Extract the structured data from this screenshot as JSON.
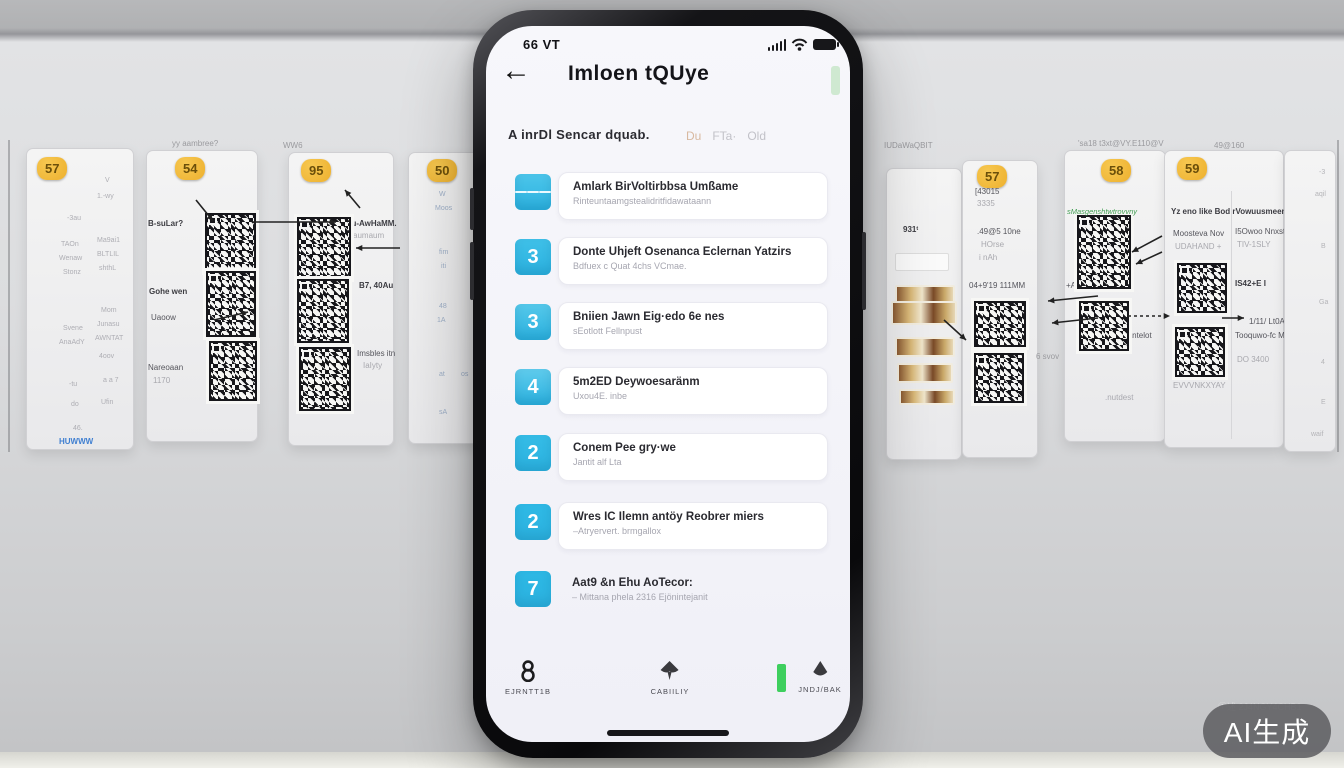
{
  "watermark": {
    "text": "AI生成",
    "faint": "①述 2J4NGY4CHB1"
  },
  "phone": {
    "status_bar": {
      "time": "66 VT",
      "icons": [
        "signal-icon",
        "wifi-icon",
        "battery-icon"
      ]
    },
    "header": {
      "back_icon": "←",
      "title": "Imloen tQUye",
      "pill_color": "#cfe9d1"
    },
    "filter": {
      "left": "A inrDl Sencar dquab.",
      "tags": [
        "Du",
        "FTa·",
        "Old"
      ],
      "tag0_color": "#d8b9a0"
    },
    "list": [
      {
        "badge": {
          "type": "list-icon",
          "value": ""
        },
        "color": "#4cc5ea",
        "title": "Amlark BirVoltirbbsa Umßame",
        "subtitle": "Rinteuntaamgstealidritfidawataann",
        "card": true
      },
      {
        "badge": {
          "type": "number",
          "value": "3"
        },
        "color": "#3fc0e8",
        "title": "Donte Uhjeft Osenanca Eclernan Yatzirs",
        "subtitle": "Bdfuex c Quat 4chs VCmae.",
        "card": true
      },
      {
        "badge": {
          "type": "number",
          "value": "3"
        },
        "color": "#55c8ea",
        "title": "Bniien Jawn Eig·edo 6e nes",
        "subtitle": "sEotlott Fellnpust",
        "card": true
      },
      {
        "badge": {
          "type": "number",
          "value": "4"
        },
        "color": "#5fcbec",
        "title": "5m2ED Deywoesaränm",
        "subtitle": "Uxou4E. inbe",
        "card": true
      },
      {
        "badge": {
          "type": "number",
          "value": "2"
        },
        "color": "#35bce6",
        "title": "Conem Pee gry·we",
        "subtitle": "Jantit alf Lta",
        "card": true
      },
      {
        "badge": {
          "type": "number",
          "value": "2"
        },
        "color": "#2fb9e5",
        "title": "Wres IC Ilemn antöy Reobrer miers",
        "subtitle": "–Atryervert. brmgallox",
        "card": true
      },
      {
        "badge": {
          "type": "number",
          "value": "7"
        },
        "color": "#2db8e4",
        "title": "Aat9 &n Ehu AoTecor:",
        "subtitle": "– Mittana phela 2316 Ejönintejanit",
        "card": false
      }
    ],
    "row_tops": [
      146,
      211,
      276,
      341,
      407,
      476,
      543
    ],
    "nav": [
      {
        "icon": "person-icon",
        "label": "EJRNTT1B"
      },
      {
        "icon": "spade-icon",
        "label": "CABIILIY"
      },
      {
        "icon": "droplet-icon",
        "label": "JNDJ/BAK",
        "accent": "#3ecf5e"
      }
    ]
  },
  "wall": {
    "badge_color": "#edb02e",
    "labels": [
      {
        "t": "yy aambree?",
        "x": 172,
        "y": 139
      },
      {
        "t": "WW6",
        "x": 283,
        "y": 141
      },
      {
        "t": "IUDaWaQBIT",
        "x": 884,
        "y": 141
      },
      {
        "t": "'sa18 t3xt@VY.E110@V",
        "x": 1078,
        "y": 139
      },
      {
        "t": "49@160",
        "x": 1214,
        "y": 141
      },
      {
        "t": "6 svov",
        "x": 1036,
        "y": 352
      }
    ],
    "panels": [
      {
        "x": 26,
        "y": 148,
        "w": 106,
        "h": 300,
        "badge": {
          "t": "57",
          "x": 10,
          "y": 8
        },
        "rows": [
          {
            "t": "V",
            "x": 78,
            "y": 28
          },
          {
            "t": "1.-wy",
            "x": 70,
            "y": 44
          },
          {
            "t": "-3au",
            "x": 40,
            "y": 66
          },
          {
            "t": "TAOn",
            "x": 34,
            "y": 92
          },
          {
            "t": "Ma9ai1",
            "x": 70,
            "y": 88
          },
          {
            "t": "Wenaw",
            "x": 32,
            "y": 106
          },
          {
            "t": "BLTLIL",
            "x": 70,
            "y": 102
          },
          {
            "t": "Stonz",
            "x": 36,
            "y": 120
          },
          {
            "t": "shthL",
            "x": 72,
            "y": 116
          },
          {
            "t": "Mom",
            "x": 74,
            "y": 158
          },
          {
            "t": "Svene",
            "x": 36,
            "y": 176
          },
          {
            "t": "Junasu",
            "x": 70,
            "y": 172
          },
          {
            "t": "AnaAdY",
            "x": 32,
            "y": 190
          },
          {
            "t": "AWNTAT",
            "x": 68,
            "y": 186
          },
          {
            "t": "4oov",
            "x": 72,
            "y": 204
          },
          {
            "t": "-tu",
            "x": 42,
            "y": 232
          },
          {
            "t": "a a 7",
            "x": 76,
            "y": 228
          },
          {
            "t": "do",
            "x": 44,
            "y": 252
          },
          {
            "t": "Ufin",
            "x": 74,
            "y": 250
          },
          {
            "t": "46.",
            "x": 46,
            "y": 276
          }
        ],
        "link": {
          "t": "HUWWW",
          "x": 32,
          "y": 288,
          "color": "#3f7fd1"
        }
      },
      {
        "x": 146,
        "y": 150,
        "w": 110,
        "h": 290,
        "badge": {
          "t": "54",
          "x": 28,
          "y": 6
        },
        "labels": [
          {
            "t": "B-suLar?",
            "x": 1,
            "y": 68,
            "b": 1
          },
          {
            "t": "Gohe wen",
            "x": 2,
            "y": 136,
            "b": 1
          },
          {
            "t": "Uaoow",
            "x": 4,
            "y": 162
          },
          {
            "t": "Nareoaan",
            "x": 1,
            "y": 212
          },
          {
            "t": "1170",
            "x": 6,
            "y": 225,
            "f": 1
          }
        ],
        "qrs": [
          {
            "x": 58,
            "y": 62,
            "w": 47,
            "h": 55
          },
          {
            "x": 59,
            "y": 120,
            "w": 46,
            "h": 62
          },
          {
            "x": 62,
            "y": 190,
            "w": 44,
            "h": 56
          }
        ]
      },
      {
        "x": 288,
        "y": 152,
        "w": 104,
        "h": 292,
        "badge": {
          "t": "95",
          "x": 12,
          "y": 6
        },
        "labels": [
          {
            "t": "Ju-AwHaMM.",
            "x": 58,
            "y": 66,
            "b": 1
          },
          {
            "t": "aumaum",
            "x": 64,
            "y": 78,
            "f": 1
          },
          {
            "t": "B7, 40Au",
            "x": 70,
            "y": 128,
            "b": 1
          },
          {
            "t": "Imsbles itn",
            "x": 68,
            "y": 196
          },
          {
            "t": "IaIyty",
            "x": 74,
            "y": 208,
            "f": 1
          }
        ],
        "qrs": [
          {
            "x": 8,
            "y": 64,
            "w": 50,
            "h": 58
          },
          {
            "x": 8,
            "y": 126,
            "w": 48,
            "h": 60
          },
          {
            "x": 10,
            "y": 194,
            "w": 48,
            "h": 60
          }
        ]
      },
      {
        "x": 408,
        "y": 152,
        "w": 96,
        "h": 290,
        "badge": {
          "t": "50",
          "x": 18,
          "y": 6
        },
        "rowColor": "#9fb0c8",
        "rows": [
          {
            "t": "W",
            "x": 30,
            "y": 38
          },
          {
            "t": "Moos",
            "x": 26,
            "y": 52
          },
          {
            "t": "fim",
            "x": 30,
            "y": 96
          },
          {
            "t": "iti",
            "x": 32,
            "y": 110
          },
          {
            "t": "48",
            "x": 30,
            "y": 150
          },
          {
            "t": "1A",
            "x": 28,
            "y": 164
          },
          {
            "t": "at",
            "x": 30,
            "y": 218
          },
          {
            "t": "os",
            "x": 52,
            "y": 218
          },
          {
            "t": "sA",
            "x": 30,
            "y": 256
          }
        ]
      },
      {
        "x": 886,
        "y": 168,
        "w": 74,
        "h": 290,
        "labels": [
          {
            "t": "931ᵗ",
            "x": 16,
            "y": 56,
            "b": 1
          }
        ],
        "box": {
          "x": 8,
          "y": 84,
          "w": 52,
          "h": 16
        },
        "photos": [
          {
            "x": 8,
            "y": 116,
            "w": 56,
            "h": 14
          },
          {
            "x": 4,
            "y": 132,
            "w": 62,
            "h": 20
          },
          {
            "x": 8,
            "y": 168,
            "w": 56,
            "h": 16
          },
          {
            "x": 10,
            "y": 194,
            "w": 52,
            "h": 16
          },
          {
            "x": 12,
            "y": 220,
            "w": 52,
            "h": 12
          }
        ]
      },
      {
        "x": 962,
        "y": 160,
        "w": 74,
        "h": 296,
        "badge": {
          "t": "57",
          "x": 14,
          "y": 4
        },
        "labels": [
          {
            "t": "[43015",
            "x": 12,
            "y": 26
          },
          {
            "t": "3335",
            "x": 14,
            "y": 38,
            "f": 1
          },
          {
            "t": ".49@5 10ne",
            "x": 14,
            "y": 66
          },
          {
            "t": "HOrse",
            "x": 18,
            "y": 79,
            "f": 1
          },
          {
            "t": "i nAh",
            "x": 16,
            "y": 92,
            "f": 1
          },
          {
            "t": "04+9'19 111MM",
            "x": 6,
            "y": 120
          }
        ],
        "qrs": [
          {
            "x": 11,
            "y": 140,
            "w": 48,
            "h": 42
          },
          {
            "x": 11,
            "y": 192,
            "w": 46,
            "h": 46
          }
        ]
      },
      {
        "x": 1064,
        "y": 150,
        "w": 100,
        "h": 290,
        "badge": {
          "t": "58",
          "x": 36,
          "y": 8
        },
        "green": {
          "t": "sMasgenshtwtrovvny",
          "x": 2,
          "y": 56
        },
        "labels": [
          {
            "t": "+Aa ssena (111",
            "x": 1,
            "y": 130
          },
          {
            "t": "I. antelot",
            "x": 56,
            "y": 180
          },
          {
            "t": ".nutdest",
            "x": 40,
            "y": 242,
            "f": 1
          }
        ],
        "qrs": [
          {
            "x": 12,
            "y": 64,
            "w": 50,
            "h": 70
          },
          {
            "x": 14,
            "y": 150,
            "w": 46,
            "h": 46
          }
        ]
      },
      {
        "x": 1164,
        "y": 150,
        "w": 118,
        "h": 296,
        "badge": {
          "t": "59",
          "x": 12,
          "y": 6
        },
        "divider": 66,
        "labels": [
          {
            "t": "Yz eno like Bod rVowuusmeenn",
            "x": 6,
            "y": 56,
            "b": 1
          },
          {
            "t": "Moosteva Nov",
            "x": 8,
            "y": 78
          },
          {
            "t": "UDAHAND +",
            "x": 10,
            "y": 91,
            "f": 1
          },
          {
            "t": "I5Owoo Nnxstoy",
            "x": 70,
            "y": 76
          },
          {
            "t": "TIV-1SLY",
            "x": 72,
            "y": 89,
            "f": 1
          },
          {
            "t": "IS42+E  I",
            "x": 70,
            "y": 128,
            "b": 1
          },
          {
            "t": "1/11/ Lt0AV",
            "x": 84,
            "y": 166
          },
          {
            "t": "Tooquwo-fc MMoaau",
            "x": 70,
            "y": 180
          },
          {
            "t": "DO 3400",
            "x": 72,
            "y": 204,
            "f": 1
          },
          {
            "t": "EVVVNKXYAY",
            "x": 8,
            "y": 230,
            "f": 1
          }
        ],
        "qrs": [
          {
            "x": 12,
            "y": 112,
            "w": 46,
            "h": 46
          },
          {
            "x": 10,
            "y": 176,
            "w": 46,
            "h": 46
          }
        ]
      },
      {
        "x": 1284,
        "y": 150,
        "w": 50,
        "h": 300,
        "rowColor": "#b4b4b8",
        "rows": [
          {
            "t": "-3",
            "x": 34,
            "y": 18
          },
          {
            "t": "aqil",
            "x": 30,
            "y": 40
          },
          {
            "t": "B",
            "x": 36,
            "y": 92
          },
          {
            "t": "Ga",
            "x": 34,
            "y": 148
          },
          {
            "t": "4",
            "x": 36,
            "y": 208
          },
          {
            "t": "E",
            "x": 36,
            "y": 248
          },
          {
            "t": "waif",
            "x": 26,
            "y": 280
          }
        ]
      }
    ],
    "arrows": [
      {
        "x1": 196,
        "y1": 200,
        "x2": 213,
        "y2": 221
      },
      {
        "x1": 360,
        "y1": 208,
        "x2": 345,
        "y2": 190
      },
      {
        "x1": 252,
        "y1": 222,
        "x2": 336,
        "y2": 222
      },
      {
        "x1": 400,
        "y1": 248,
        "x2": 356,
        "y2": 248
      },
      {
        "x1": 214,
        "y1": 320,
        "x2": 248,
        "y2": 312
      },
      {
        "x1": 944,
        "y1": 320,
        "x2": 966,
        "y2": 340
      },
      {
        "x1": 1098,
        "y1": 296,
        "x2": 1048,
        "y2": 301
      },
      {
        "x1": 1098,
        "y1": 318,
        "x2": 1052,
        "y2": 323
      },
      {
        "x1": 1128,
        "y1": 316,
        "x2": 1170,
        "y2": 316,
        "dash": 1
      },
      {
        "x1": 1222,
        "y1": 318,
        "x2": 1244,
        "y2": 318
      },
      {
        "x1": 1162,
        "y1": 236,
        "x2": 1132,
        "y2": 252
      },
      {
        "x1": 1162,
        "y1": 252,
        "x2": 1136,
        "y2": 264
      }
    ]
  }
}
